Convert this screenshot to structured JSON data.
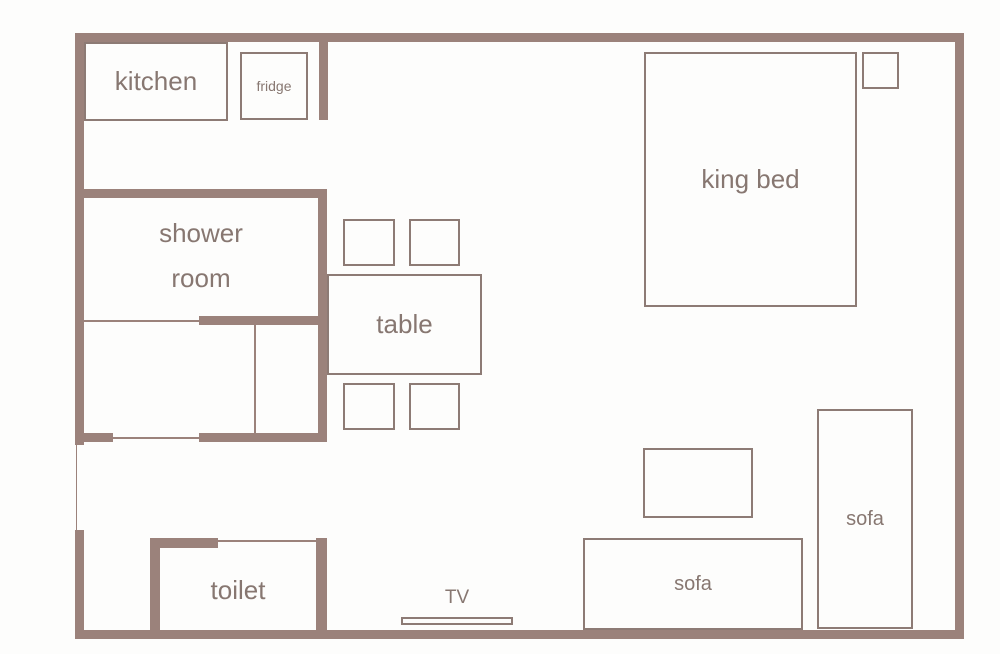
{
  "palette": {
    "wall": "#9b827b",
    "line": "#8d7b75",
    "text": "#877771",
    "background": "#fdfdfc"
  },
  "labels": {
    "kitchen": "kitchen",
    "fridge": "fridge",
    "shower_line1": "shower",
    "shower_line2": "room",
    "table": "table",
    "king_bed": "king bed",
    "toilet": "toilet",
    "tv": "TV",
    "sofa_bottom": "sofa",
    "sofa_right": "sofa"
  }
}
